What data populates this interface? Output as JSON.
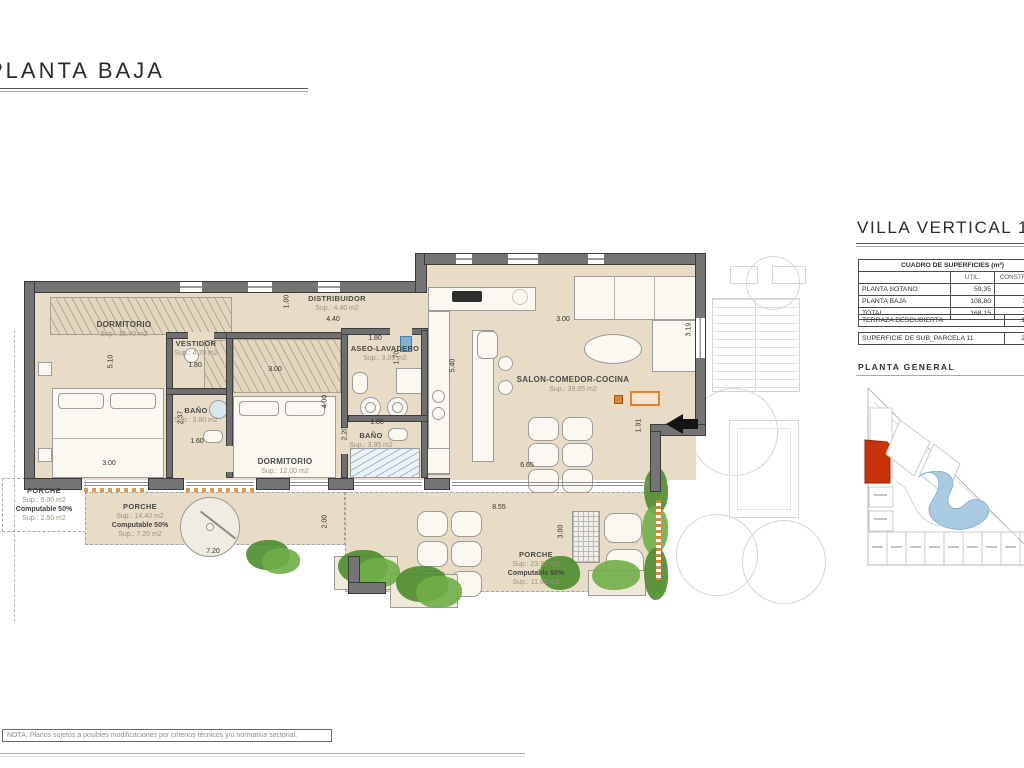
{
  "sheet": {
    "title": "PLANTA BAJA",
    "note": "NOTA: Planos sujetos a posibles modificaciones por criterios técnicos y/o normativa sectorial."
  },
  "right_panel": {
    "title": "VILLA VERTICAL 11",
    "surfaces_table": {
      "title": "CUADRO DE SUPERFICIES (m²)",
      "col_util": "UTIL.",
      "col_construida": "CONSTRUIDA",
      "rows": [
        {
          "label": "PLANTA SOTANO",
          "util": "59,35",
          "construida": "64,50"
        },
        {
          "label": "PLANTA BAJA",
          "util": "108,80",
          "construida": "124,85"
        },
        {
          "label": "TOTAL",
          "util": "168,15",
          "construida": "189,35"
        }
      ],
      "terraza_label": "TERRAZA DESCUBIERTA",
      "terraza_value": "124,40",
      "parcela_label": "SUPERFICIE DE SUB_PARCELA 11",
      "parcela_value": "281,95"
    },
    "site_plan_title": "PLANTA GENERAL"
  },
  "rooms": [
    {
      "name": "DORMITORIO",
      "sup": "Sup.: 15.40 m2"
    },
    {
      "name": "VESTIDOR",
      "sup": "Sup.: 4.70 m2"
    },
    {
      "name": "BAÑO",
      "sup": "Sup.: 3.80 m2"
    },
    {
      "name": "DISTRIBUIDOR",
      "sup": "Sup.: 4.40 m2"
    },
    {
      "name": "ASEO-LAVADERO",
      "sup": "Sup.: 3.05 m2"
    },
    {
      "name": "DORMITORIO",
      "sup": "Sup.: 12.00 m2"
    },
    {
      "name": "BAÑO",
      "sup": "Sup.: 3.95 m2"
    },
    {
      "name": "SALON-COMEDOR-COCINA",
      "sup": "Sup.: 39.85 m2"
    }
  ],
  "porches": [
    {
      "name": "PORCHE",
      "sup": "Sup.: 5.00 m2",
      "comp": "Computable 50%",
      "comp_sup": "Sup.: 2.50 m2"
    },
    {
      "name": "PORCHE",
      "sup": "Sup.: 14.40 m2",
      "comp": "Computable 50%",
      "comp_sup": "Sup.: 7.20 m2"
    },
    {
      "name": "PORCHE",
      "sup": "Sup.: 23.90 m2",
      "comp": "Computable 50%",
      "comp_sup": "Sup.: 11.95 m2"
    }
  ],
  "dims": [
    "5.10",
    "3.00",
    "2.37",
    "1.60",
    "1.80",
    "1.00",
    "4.40",
    "3.00",
    "4.00",
    "1.80",
    "1.70",
    "1.80",
    "2.20",
    "5.40",
    "3.00",
    "3.19",
    "1.91",
    "6.65",
    "8.55",
    "3.00",
    "7.20",
    "2.00"
  ],
  "colors": {
    "wall": "#747474",
    "floor_tan": "#e8dcc6",
    "highlight_red": "#c8330a",
    "pool_blue": "#a9cbe2",
    "accent_orange": "#e0822c",
    "plant_green": "#6fae48"
  }
}
